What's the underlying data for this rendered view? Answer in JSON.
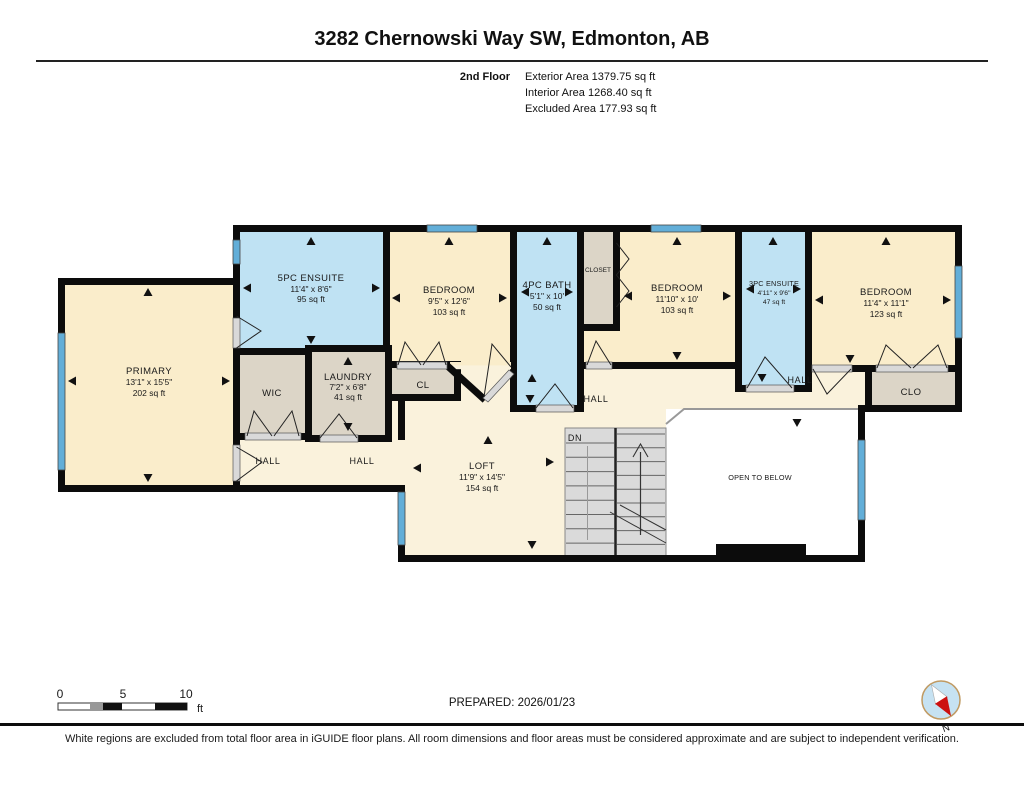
{
  "header": {
    "title": "3282 Chernowski Way SW, Edmonton, AB",
    "floor_label": "2nd Floor",
    "stats": {
      "exterior": "Exterior Area 1379.75 sq ft",
      "interior": "Interior Area 1268.40 sq ft",
      "excluded": "Excluded Area 177.93 sq ft"
    }
  },
  "rooms": {
    "primary": {
      "name": "PRIMARY",
      "dims": "13'1\" x 15'5\"",
      "area": "202 sq ft"
    },
    "ensuite5": {
      "name": "5PC ENSUITE",
      "dims": "11'4\" x 8'6\"",
      "area": "95 sq ft"
    },
    "bedroom_a": {
      "name": "BEDROOM",
      "dims": "9'5\" x 12'6\"",
      "area": "103 sq ft"
    },
    "bath": {
      "name": "4PC BATH",
      "dims": "5'1\" x 10'",
      "area": "50 sq ft"
    },
    "closet": {
      "name": "CLOSET"
    },
    "bedroom_b": {
      "name": "BEDROOM",
      "dims": "11'10\" x 10'",
      "area": "103 sq ft"
    },
    "ensuite3": {
      "name": "3PC ENSUITE",
      "dims": "4'11\" x 9'6\"",
      "area": "47 sq ft"
    },
    "bedroom_c": {
      "name": "BEDROOM",
      "dims": "11'4\" x 11'1\"",
      "area": "123 sq ft"
    },
    "wic": {
      "name": "WIC"
    },
    "laundry": {
      "name": "LAUNDRY",
      "dims": "7'2\" x 6'8\"",
      "area": "41 sq ft"
    },
    "cl": {
      "name": "CL"
    },
    "clo": {
      "name": "CLO"
    },
    "loft": {
      "name": "LOFT",
      "dims": "11'9\" x 14'5\"",
      "area": "154 sq ft"
    }
  },
  "halls": {
    "nw": "HALL",
    "w": "HALL",
    "center": "HALL",
    "east": "HALL"
  },
  "annotations": {
    "open_to_below": "OPEN TO BELOW",
    "down": "DN"
  },
  "scale_bar": {
    "tick0": "0",
    "tick5": "5",
    "tick10": "10",
    "unit": "ft"
  },
  "compass": {
    "north": "N"
  },
  "footer": {
    "prepared": "PREPARED: 2026/01/23",
    "disclaimer": "White regions are excluded from total floor area in iGUIDE floor plans. All room dimensions and floor areas must be considered approximate and are subject to independent verification."
  },
  "colors": {
    "room-cream": "#FAEDCB",
    "hall-cream": "#FAF2DC",
    "bath-blue": "#BFE2F3",
    "closet-tan": "#DCD5C7",
    "window-blue": "#62AED8",
    "wall-black": "#0C0C0C"
  }
}
